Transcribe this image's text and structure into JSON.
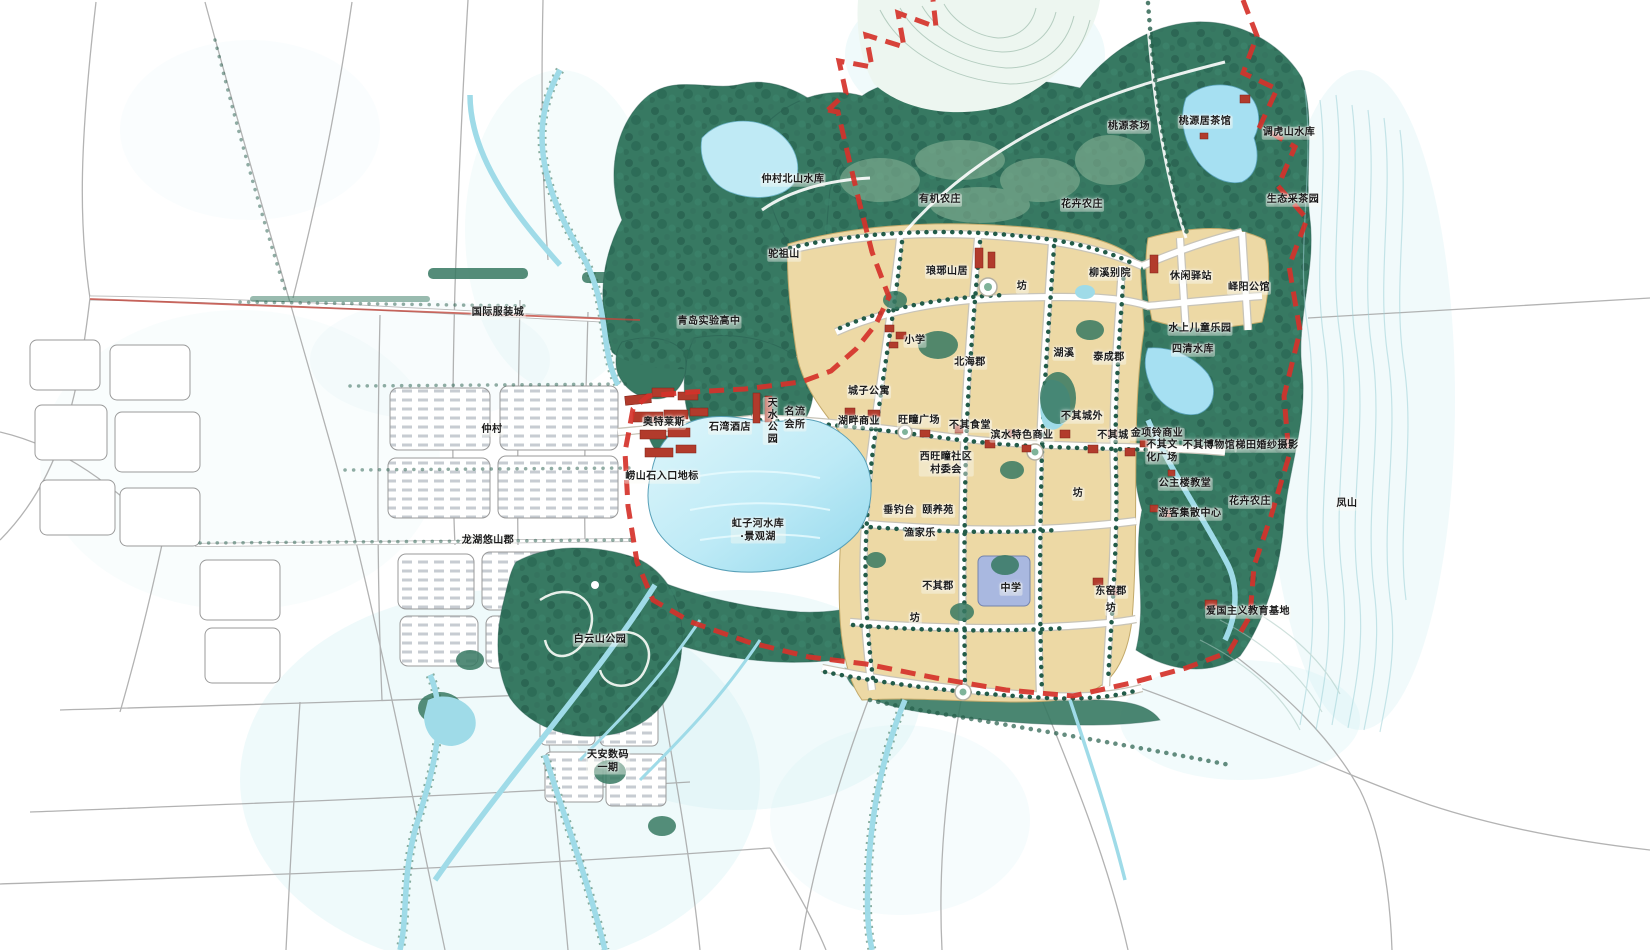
{
  "map": {
    "type": "hand-painted urban master plan",
    "colors": {
      "forest": "#37796293",
      "forest-solid": "#377962",
      "forest-dark": "#23544a",
      "water": "#a6e0f2",
      "water-light": "#cdeef2",
      "block": "#edd9a5",
      "block-edge": "#c2a96a",
      "road": "#a0a0a0",
      "boundary": "#d5322a",
      "red-bldg": "#b23b2c"
    },
    "labels": [
      {
        "text": "国际服装城",
        "x": 498,
        "y": 313
      },
      {
        "text": "青岛实验高中",
        "x": 709,
        "y": 322
      },
      {
        "text": "仲村北山水库",
        "x": 793,
        "y": 180
      },
      {
        "text": "驼祖山",
        "x": 784,
        "y": 255
      },
      {
        "text": "有机农庄",
        "x": 940,
        "y": 200
      },
      {
        "text": "花卉农庄",
        "x": 1082,
        "y": 205
      },
      {
        "text": "桃源茶场",
        "x": 1129,
        "y": 127
      },
      {
        "text": "桃源居茶馆",
        "x": 1205,
        "y": 122
      },
      {
        "text": "调虎山水库",
        "x": 1289,
        "y": 133
      },
      {
        "text": "生态采茶园",
        "x": 1293,
        "y": 200
      },
      {
        "text": "琅琊山居",
        "x": 947,
        "y": 272
      },
      {
        "text": "坊",
        "x": 1022,
        "y": 287
      },
      {
        "text": "柳溪别院",
        "x": 1110,
        "y": 274
      },
      {
        "text": "休闲驿站",
        "x": 1191,
        "y": 277
      },
      {
        "text": "峄阳公馆",
        "x": 1249,
        "y": 288
      },
      {
        "text": "小学",
        "x": 915,
        "y": 341
      },
      {
        "text": "北海郡",
        "x": 970,
        "y": 363
      },
      {
        "text": "湖溪",
        "x": 1064,
        "y": 354
      },
      {
        "text": "泰成郡",
        "x": 1109,
        "y": 358
      },
      {
        "text": "水上儿童乐园",
        "x": 1200,
        "y": 329
      },
      {
        "text": "四清水库",
        "x": 1193,
        "y": 350
      },
      {
        "text": "城子公寓",
        "x": 869,
        "y": 392
      },
      {
        "text": "天水公园",
        "x": 770,
        "y": 421,
        "vertical": true
      },
      {
        "text": "名流\n会所",
        "x": 795,
        "y": 419
      },
      {
        "text": "奥特莱斯",
        "x": 664,
        "y": 423
      },
      {
        "text": "石湾酒店",
        "x": 730,
        "y": 428
      },
      {
        "text": "湖畔商业",
        "x": 859,
        "y": 422
      },
      {
        "text": "旺疃广场",
        "x": 919,
        "y": 421
      },
      {
        "text": "不其食堂",
        "x": 970,
        "y": 426
      },
      {
        "text": "滨水特色商业",
        "x": 1022,
        "y": 436
      },
      {
        "text": "不其城外",
        "x": 1082,
        "y": 417
      },
      {
        "text": "不其城",
        "x": 1113,
        "y": 436
      },
      {
        "text": "金项铃商业",
        "x": 1157,
        "y": 434
      },
      {
        "text": "不其文\n化广场",
        "x": 1162,
        "y": 452
      },
      {
        "text": "不其博物馆",
        "x": 1209,
        "y": 446
      },
      {
        "text": "梯田婚纱摄影",
        "x": 1267,
        "y": 446
      },
      {
        "text": "崂山石入口地标",
        "x": 662,
        "y": 477
      },
      {
        "text": "西旺疃社区\n村委会",
        "x": 946,
        "y": 464
      },
      {
        "text": "公主楼教堂",
        "x": 1185,
        "y": 484
      },
      {
        "text": "坊",
        "x": 1078,
        "y": 494
      },
      {
        "text": "垂钓台",
        "x": 899,
        "y": 511
      },
      {
        "text": "颐养苑",
        "x": 938,
        "y": 511
      },
      {
        "text": "游客集散中心",
        "x": 1190,
        "y": 514
      },
      {
        "text": "花卉农庄",
        "x": 1250,
        "y": 502
      },
      {
        "text": "凤山",
        "x": 1347,
        "y": 504
      },
      {
        "text": "渔家乐",
        "x": 920,
        "y": 534
      },
      {
        "text": "虹子河水库\n·景观湖",
        "x": 758,
        "y": 531
      },
      {
        "text": "龙湖悠山郡",
        "x": 488,
        "y": 541
      },
      {
        "text": "仲村",
        "x": 492,
        "y": 430
      },
      {
        "text": "不其郡",
        "x": 938,
        "y": 587
      },
      {
        "text": "中学",
        "x": 1011,
        "y": 589
      },
      {
        "text": "东窑郡",
        "x": 1111,
        "y": 592
      },
      {
        "text": "坊",
        "x": 1111,
        "y": 609
      },
      {
        "text": "爱国主义教育基地",
        "x": 1248,
        "y": 612
      },
      {
        "text": "坊",
        "x": 915,
        "y": 619
      },
      {
        "text": "白云山公园",
        "x": 600,
        "y": 640
      },
      {
        "text": "天安数码\n一期",
        "x": 608,
        "y": 762
      }
    ]
  }
}
